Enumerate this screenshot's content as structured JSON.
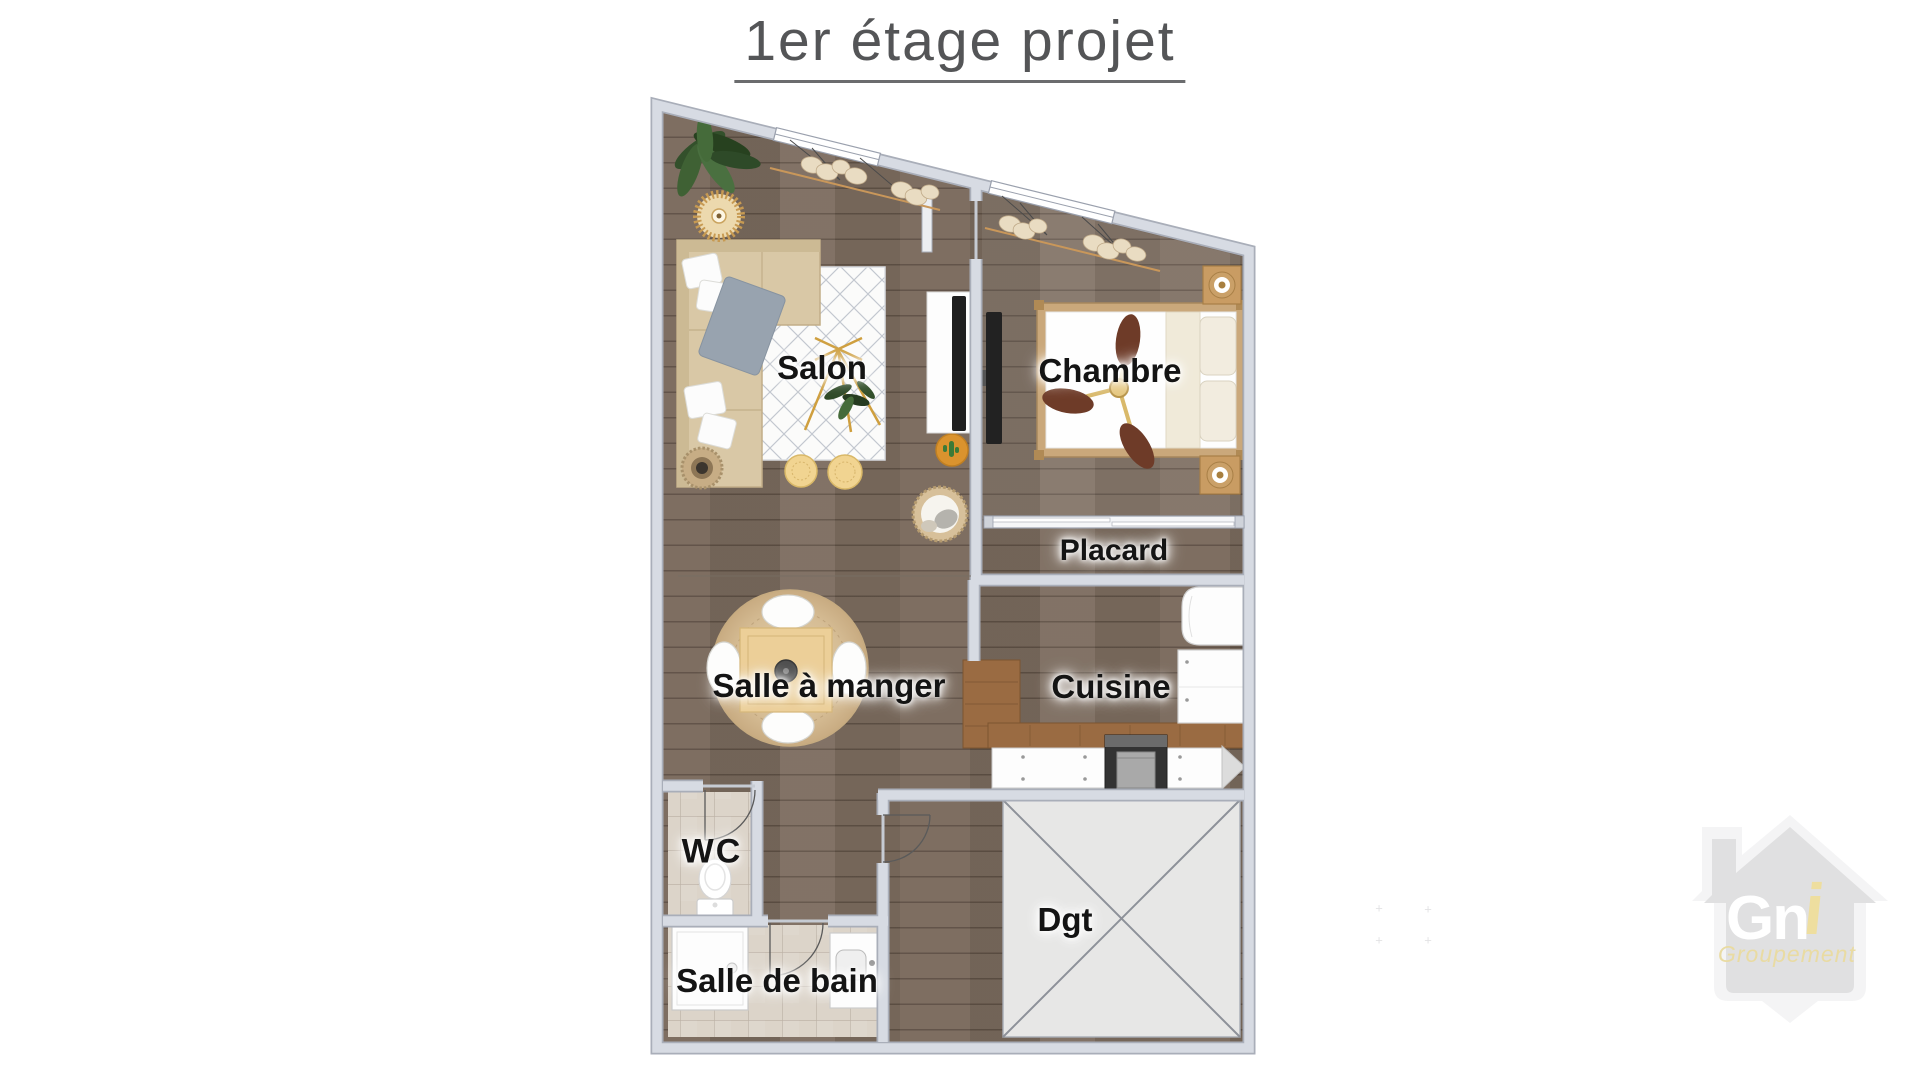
{
  "title": "1er étage projet",
  "rooms": {
    "salon": "Salon",
    "chambre": "Chambre",
    "placard": "Placard",
    "salle_a_manger": "Salle à manger",
    "cuisine": "Cuisine",
    "wc": "WC",
    "dgt": "Dgt",
    "salle_de_bain": "Salle de bain"
  },
  "watermark": {
    "brand_main": "Gn",
    "brand_accent": "i",
    "subtitle": "Groupement"
  },
  "colors": {
    "title_text": "#545557",
    "label_text": "#141414",
    "wall_fill": "#d7dbe3",
    "wall_outline": "#a9aeb9",
    "wood_floor": "#7b6b5e",
    "tile_floor": "#dcd4c9",
    "void_area_fill": "#e7e7e6",
    "counter_wood": "#9a6b42",
    "sofa_beige": "#d9c8a6",
    "bed_frame_tan": "#caa87b",
    "accent_gold": "#cf9f3e",
    "curtain_rod_tan": "#c9975a",
    "watermark_house_gray": "#dbdbdc",
    "watermark_yellow": "#e8d795"
  },
  "furniture_icons": [
    "sofa-icon",
    "area-rug-icon",
    "floor-lamp-icon",
    "potted-plant-icon",
    "rattan-pendant-icon",
    "pouf-icon",
    "tv-icon",
    "double-bed-icon",
    "ceiling-fan-icon",
    "nightstand-lamp-icon",
    "sliding-closet-door-icon",
    "dining-table-icon",
    "chair-icon",
    "pendant-light-icon",
    "kitchen-counter-icon",
    "stove-icon",
    "fridge-icon",
    "toilet-icon",
    "shower-icon",
    "washbasin-icon",
    "door-swing-icon",
    "window-icon",
    "curtain-icon",
    "stair-void-cross-icon",
    "pet-bed-icon",
    "cactus-rug-icon"
  ]
}
